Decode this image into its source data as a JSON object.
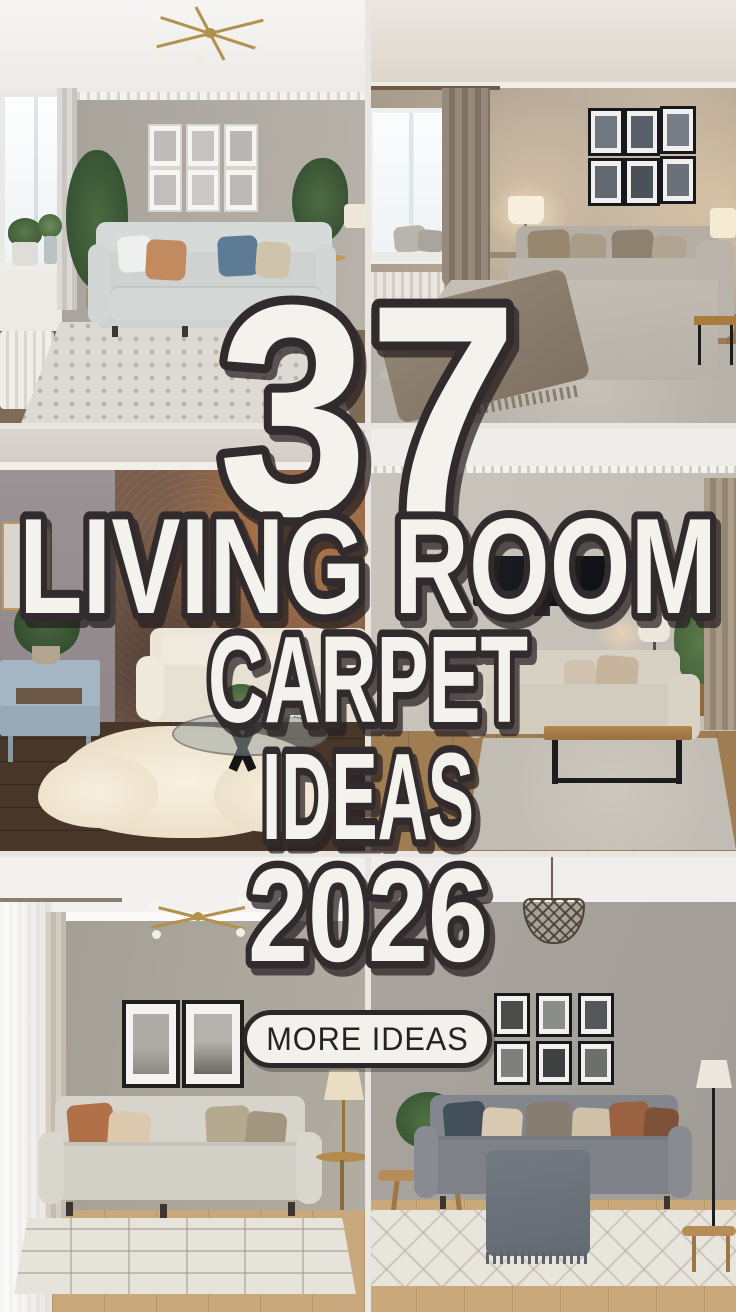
{
  "overlay": {
    "number": "37",
    "title_lines": [
      "LIVING ROOM",
      "CARPET",
      "IDEAS",
      "2026"
    ],
    "cta_label": "MORE IDEAS"
  },
  "colors": {
    "text_fill": "#f4f2ed",
    "text_outline": "#322b2d",
    "text_shadow": "#26201f",
    "pill_bg": "#f3f1ec",
    "pill_border": "#2c2728",
    "pill_text": "#232323",
    "divider": "#e9e6e1",
    "copper_wall": "#8a6a52",
    "warm_wood_floor": "#9b7a55"
  },
  "photos": [
    {
      "label": "light gray sofa, gallery wall, dotted pale rug"
    },
    {
      "label": "taupe room, gray sectional with throw, gray rug"
    },
    {
      "label": "copper accent wall, cream sofa, white sheepskin rug"
    },
    {
      "label": "TV wall, beige sofa, wood coffee table, gray rug"
    },
    {
      "label": "greige room, terracotta pillows, geometric cream rug"
    },
    {
      "label": "gray sofa, black frame gallery, trellis pattern rug"
    }
  ]
}
